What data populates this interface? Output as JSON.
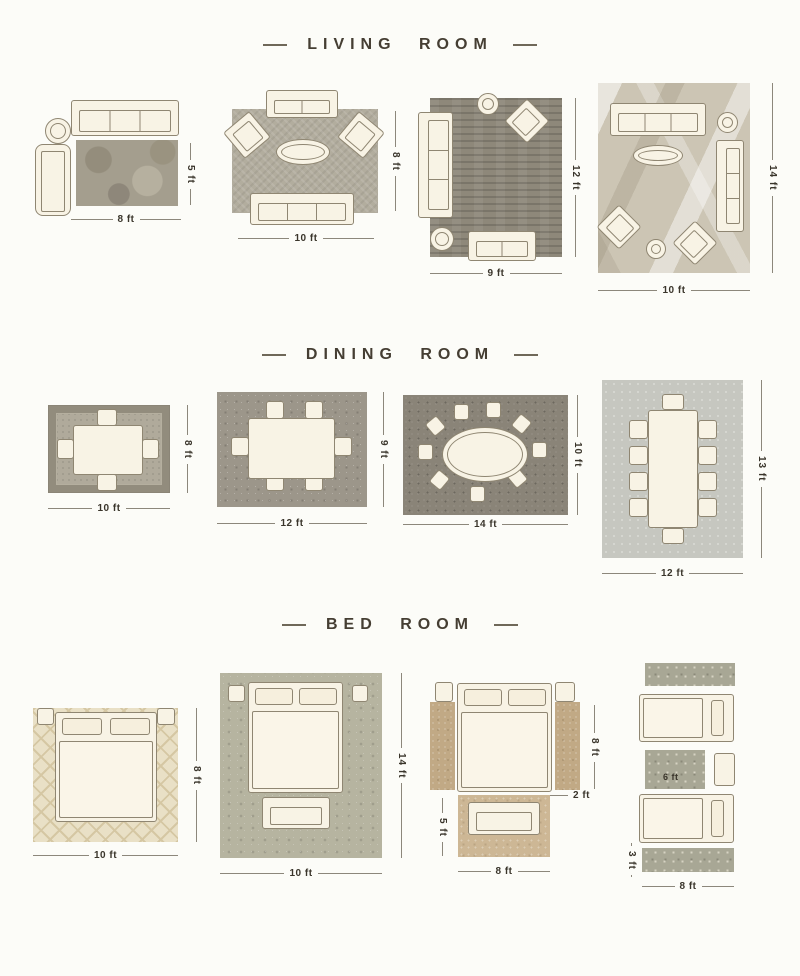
{
  "sections": {
    "living": {
      "title": "LIVING ROOM",
      "layouts": [
        {
          "height": "5 ft",
          "width": "8 ft"
        },
        {
          "height": "8 ft",
          "width": "10 ft"
        },
        {
          "height": "12 ft",
          "width": "9 ft"
        },
        {
          "height": "14 ft",
          "width": "10 ft"
        }
      ]
    },
    "dining": {
      "title": "DINING ROOM",
      "layouts": [
        {
          "height": "8 ft",
          "width": "10 ft"
        },
        {
          "height": "9 ft",
          "width": "12 ft"
        },
        {
          "height": "10 ft",
          "width": "14 ft"
        },
        {
          "height": "13 ft",
          "width": "12 ft"
        }
      ]
    },
    "bed": {
      "title": "BED ROOM",
      "layouts": [
        {
          "height": "8 ft",
          "width": "10 ft"
        },
        {
          "height": "14 ft",
          "width": "10 ft"
        },
        {
          "runner_height": "8 ft",
          "runner_width": "2 ft",
          "foot_rug_height": "5 ft",
          "width": "8 ft"
        },
        {
          "mid_rug_width": "6 ft",
          "runner_height": "3 ft",
          "width": "8 ft"
        }
      ]
    }
  },
  "colors": {
    "title_text": "#453e33",
    "dimension_text": "#3a352b",
    "furniture_fill": "#f8f3e5",
    "furniture_outline": "#8f8672"
  }
}
